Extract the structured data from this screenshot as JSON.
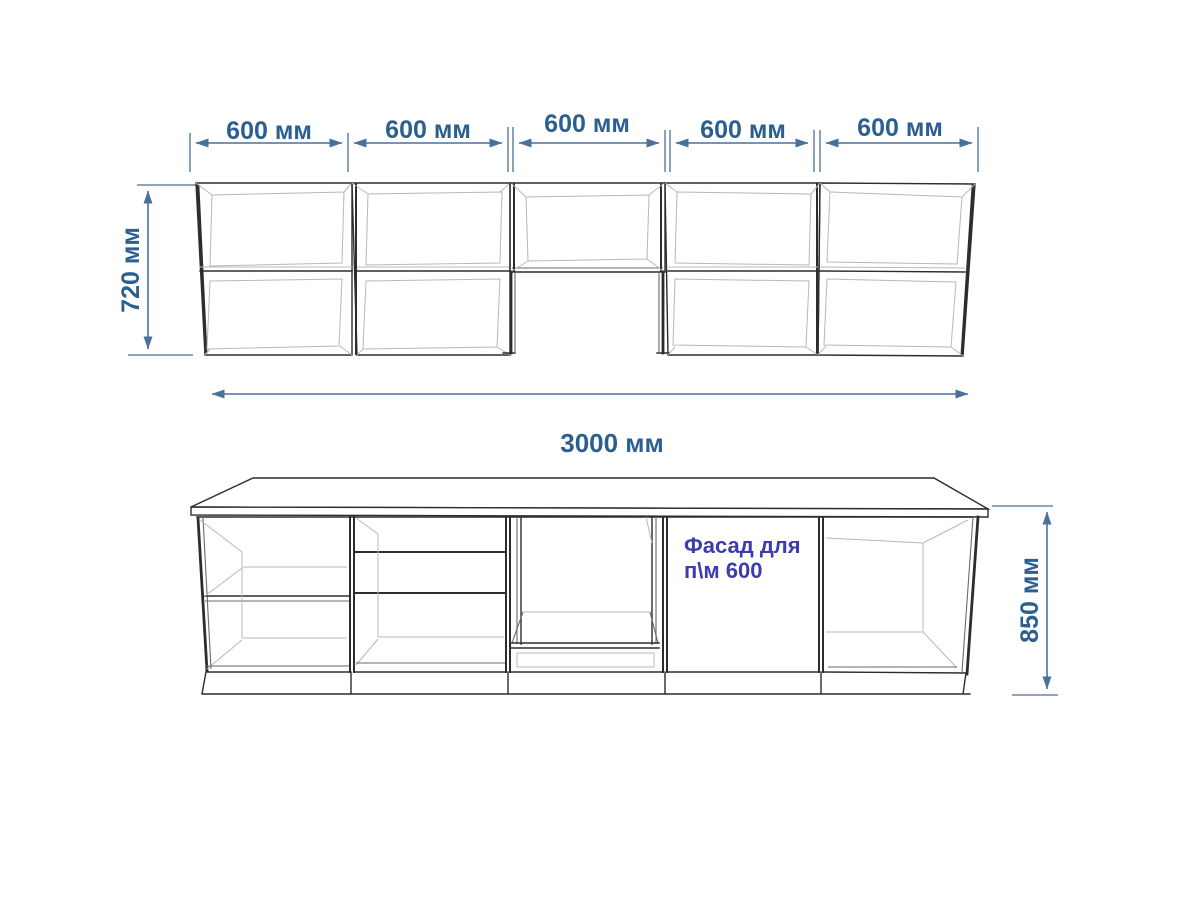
{
  "drawing": {
    "title_hint": "kitchen-cabinets-elevation",
    "units": "мм",
    "dimensions": {
      "upper_segment_labels": [
        "600 мм",
        "600 мм",
        "600 мм",
        "600 мм",
        "600 мм"
      ],
      "upper_height_label": "720 мм",
      "total_width_label": "3000 мм",
      "lower_height_label": "850 мм"
    },
    "facade_note": {
      "line1": "Фасад для",
      "line2": "п\\м 600"
    },
    "structure": {
      "upper_cabinets_count": 5,
      "lower_cabinets_count": 5
    },
    "colors": {
      "dimension_text": "#2b5f92",
      "dimension_line": "#4a719c",
      "facade_text": "#3c3caf",
      "outline": "#2d2d2d",
      "mid_line": "#6a6a6a",
      "light_line": "#b8b8b8",
      "background": "#ffffff"
    }
  }
}
